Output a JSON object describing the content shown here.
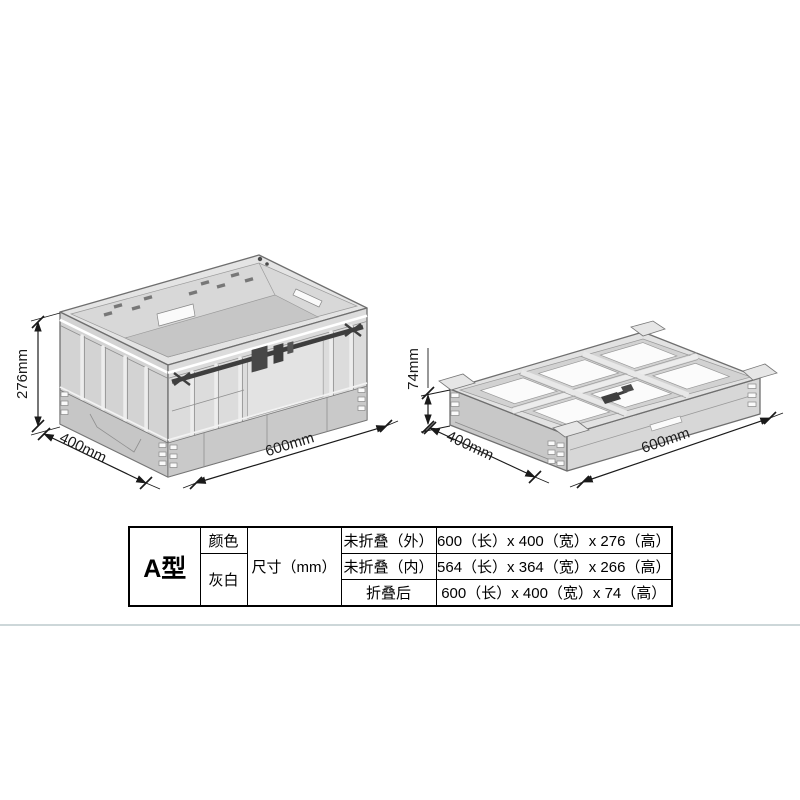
{
  "figures": {
    "unfolded": {
      "description": "unfolded collapsible crate isometric drawing",
      "height_label": "276mm",
      "depth_label": "400mm",
      "width_label": "600mm"
    },
    "folded": {
      "description": "folded collapsible crate isometric drawing",
      "height_label": "74mm",
      "depth_label": "400mm",
      "width_label": "600mm"
    }
  },
  "spec_table": {
    "model": "A型",
    "color_header": "颜色",
    "color_value": "灰白",
    "size_header": "尺寸（mm）",
    "rows": [
      {
        "label": "未折叠（外）",
        "value": "600（长）x 400（宽）x 276（高）"
      },
      {
        "label": "未折叠（内）",
        "value": "564（长）x 364（宽）x 266（高）"
      },
      {
        "label": "折叠后",
        "value": "600（长）x 400（宽）x 74（高）"
      }
    ]
  },
  "colors": {
    "crate_body": "#d6d6d6",
    "crate_rim": "#e4e4e4",
    "crate_floor": "#c6c6c6",
    "crate_outline": "#6f6f6f",
    "latch_dark": "#3f3f3f",
    "window_white": "#fbfbfb",
    "dim_text": "#1a1a1a",
    "table_border": "#000000",
    "separator_line": "#cdd7d9"
  }
}
